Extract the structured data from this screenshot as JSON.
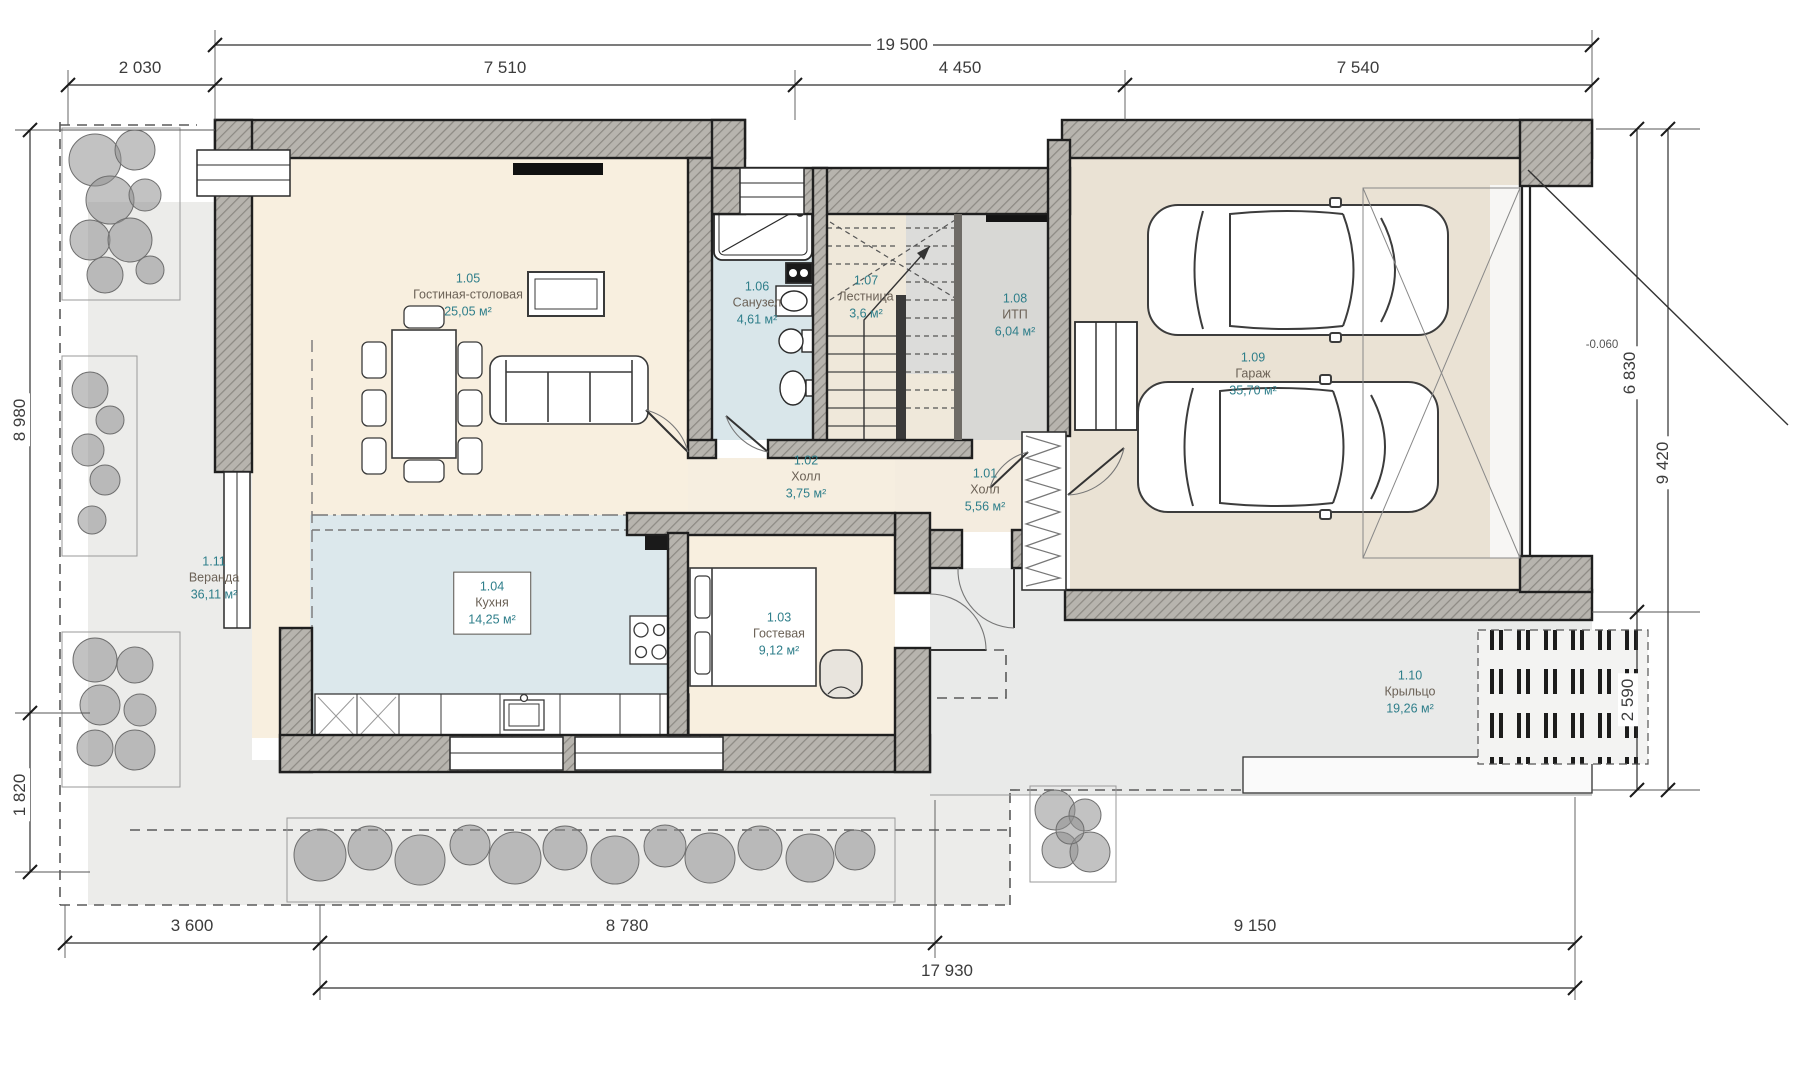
{
  "plan": {
    "title": "План 1 этажа",
    "rooms": [
      {
        "number": "1.01",
        "name": "Холл",
        "area": "5,56 м²"
      },
      {
        "number": "1.02",
        "name": "Холл",
        "area": "3,75 м²"
      },
      {
        "number": "1.03",
        "name": "Гостевая",
        "area": "9,12 м²"
      },
      {
        "number": "1.04",
        "name": "Кухня",
        "area": "14,25 м²"
      },
      {
        "number": "1.05",
        "name": "Гостиная-столовая",
        "area": "25,05 м²"
      },
      {
        "number": "1.06",
        "name": "Санузел",
        "area": "4,61 м²"
      },
      {
        "number": "1.07",
        "name": "Лестница",
        "area": "3,6 м²"
      },
      {
        "number": "1.08",
        "name": "ИТП",
        "area": "6,04 м²"
      },
      {
        "number": "1.09",
        "name": "Гараж",
        "area": "35,70 м²"
      },
      {
        "number": "1.10",
        "name": "Крыльцо",
        "area": "19,26 м²"
      },
      {
        "number": "1.11",
        "name": "Веранда",
        "area": "36,11 м²"
      }
    ],
    "dimensions": {
      "top_total": "19 500",
      "top_segments": [
        "2 030",
        "7 510",
        "4 450",
        "7 540"
      ],
      "left": [
        "8 980",
        "1 820"
      ],
      "right": [
        "6 830",
        "9 420",
        "2 590"
      ],
      "bottom_segments": [
        "3 600",
        "8 780",
        "9 150"
      ],
      "bottom_total": "17 930",
      "elevation_mark": "-0.060"
    },
    "colors": {
      "wall_hatch": "#b7b4ae",
      "wall_edge": "#1f1f1f",
      "room_cream": "#f8efdf",
      "room_blue": "#dce8ec",
      "room_gray": "#d8d8d5",
      "garage_tan": "#eae2d4",
      "outdoor_gray": "#ececea",
      "label_accent": "#2e7e8a",
      "label_name": "#6b6156",
      "dim_text": "#3c3c3c"
    }
  }
}
